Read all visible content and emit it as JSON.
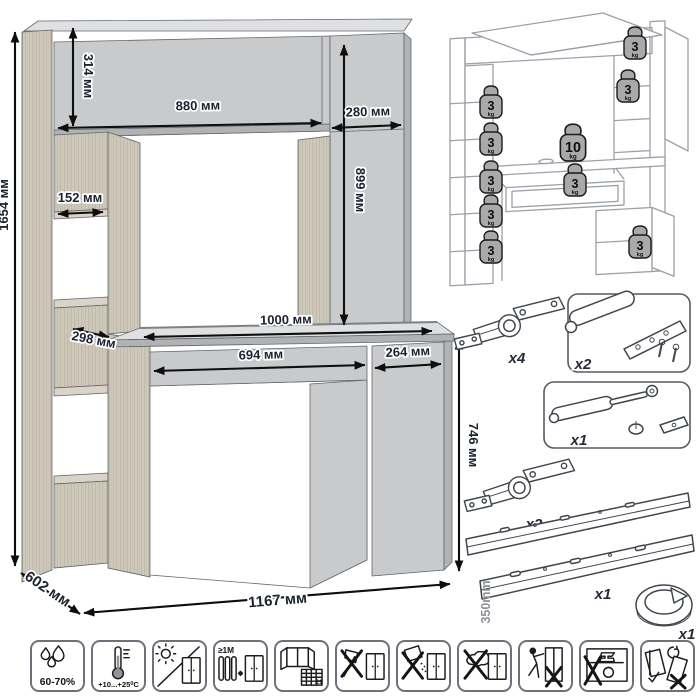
{
  "main_drawing": {
    "dims": {
      "total_height": "1654 мм",
      "hutch_panel_height": "314 мм",
      "hutch_width": "880 мм",
      "cabinet_top_width": "280 мм",
      "cabinet_top_height": "899 мм",
      "shelf_width": "152 мм",
      "shelf_depth": "298 мм",
      "desktop_width": "1000 мм",
      "drawer_width": "694 мм",
      "door_width": "264 мм",
      "desk_height": "746 мм",
      "depth": "602 мм",
      "total_width": "1167 мм"
    }
  },
  "load_diagram": {
    "weights": [
      {
        "value": "3",
        "unit": "kg"
      },
      {
        "value": "3",
        "unit": "kg"
      },
      {
        "value": "3",
        "unit": "kg"
      },
      {
        "value": "3",
        "unit": "kg"
      },
      {
        "value": "3",
        "unit": "kg"
      },
      {
        "value": "3",
        "unit": "kg"
      },
      {
        "value": "3",
        "unit": "kg"
      },
      {
        "value": "10",
        "unit": "kg"
      },
      {
        "value": "3",
        "unit": "kg"
      },
      {
        "value": "3",
        "unit": "kg"
      }
    ]
  },
  "hardware": {
    "items": [
      {
        "name": "concealed-hinge",
        "qty": "x4"
      },
      {
        "name": "push-latch",
        "qty": "x2"
      },
      {
        "name": "gas-lift-strut",
        "qty": "x1"
      },
      {
        "name": "concealed-hinge",
        "qty": "x2"
      },
      {
        "name": "drawer-slides",
        "qty": "x1",
        "length": "350mm"
      },
      {
        "name": "cable-grommet",
        "qty": "x1"
      }
    ]
  },
  "care_icons": {
    "items": [
      {
        "name": "humidity-range",
        "label": "60-70%"
      },
      {
        "name": "temperature-range",
        "label": "+10...+25⁰С"
      },
      {
        "name": "no-direct-sunlight",
        "label": ""
      },
      {
        "name": "min-distance-from-heaters",
        "label": "≥1M"
      },
      {
        "name": "ventilate-room",
        "label": "21"
      },
      {
        "name": "no-sharp-tools",
        "label": ""
      },
      {
        "name": "no-abrasive-cleaners",
        "label": ""
      },
      {
        "name": "no-wet-cleaning",
        "label": ""
      },
      {
        "name": "no-dragging",
        "label": ""
      },
      {
        "name": "no-heavy-objects-inside",
        "label": ""
      },
      {
        "name": "transport-upright",
        "label": ""
      }
    ]
  }
}
